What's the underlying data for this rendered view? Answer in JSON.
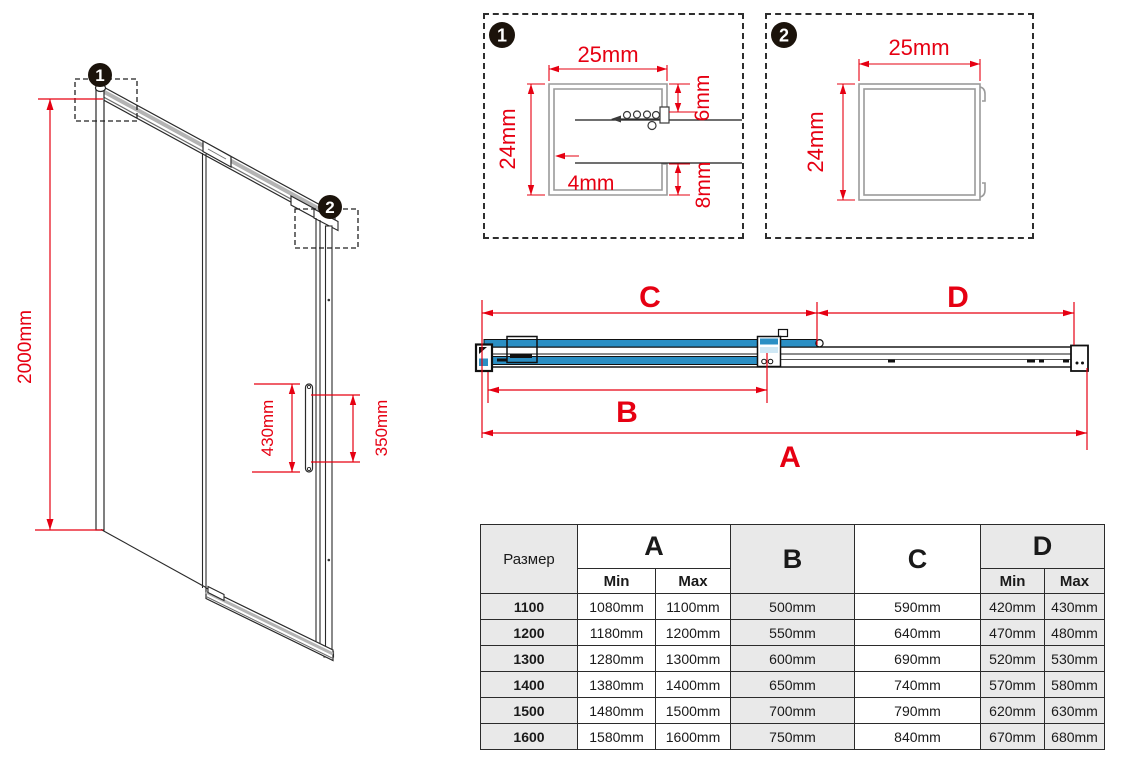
{
  "colors": {
    "red": "#e60012",
    "blue": "#2b8fc4",
    "table_gray": "#e9e9e9",
    "profile_gray": "#9a9a9a"
  },
  "iso_view": {
    "marker1": "1",
    "marker2": "2",
    "height_label": "2000mm",
    "handle_length_label": "430mm",
    "handle_holes_label": "350mm"
  },
  "detail1": {
    "badge": "1",
    "width_label": "25mm",
    "height_label": "24mm",
    "top_lip_label": "6mm",
    "wall_label": "4mm",
    "bottom_lip_label": "8mm"
  },
  "detail2": {
    "badge": "2",
    "width_label": "25mm",
    "height_label": "24mm"
  },
  "plan_view": {
    "dim_c": "C",
    "dim_d": "D",
    "dim_b": "B",
    "dim_a": "A"
  },
  "size_table": {
    "size_header": "Размер",
    "col_a": "A",
    "col_b": "B",
    "col_c": "C",
    "col_d": "D",
    "min_label": "Min",
    "max_label": "Max",
    "min_label2": "Min",
    "max_label2": "Max",
    "rows": [
      {
        "size": "1100",
        "a_min": "1080mm",
        "a_max": "1100mm",
        "b": "500mm",
        "c": "590mm",
        "d_min": "420mm",
        "d_max": "430mm"
      },
      {
        "size": "1200",
        "a_min": "1180mm",
        "a_max": "1200mm",
        "b": "550mm",
        "c": "640mm",
        "d_min": "470mm",
        "d_max": "480mm"
      },
      {
        "size": "1300",
        "a_min": "1280mm",
        "a_max": "1300mm",
        "b": "600mm",
        "c": "690mm",
        "d_min": "520mm",
        "d_max": "530mm"
      },
      {
        "size": "1400",
        "a_min": "1380mm",
        "a_max": "1400mm",
        "b": "650mm",
        "c": "740mm",
        "d_min": "570mm",
        "d_max": "580mm"
      },
      {
        "size": "1500",
        "a_min": "1480mm",
        "a_max": "1500mm",
        "b": "700mm",
        "c": "790mm",
        "d_min": "620mm",
        "d_max": "630mm"
      },
      {
        "size": "1600",
        "a_min": "1580mm",
        "a_max": "1600mm",
        "b": "750mm",
        "c": "840mm",
        "d_min": "670mm",
        "d_max": "680mm"
      }
    ]
  }
}
